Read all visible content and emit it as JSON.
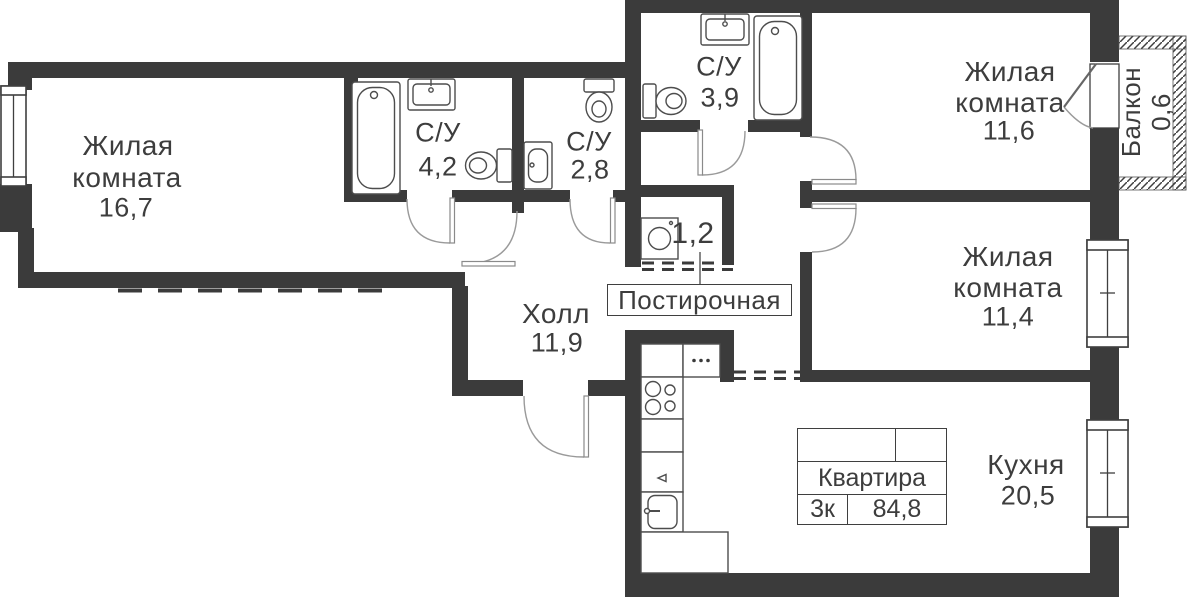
{
  "colors": {
    "wall": "#3b3b3b",
    "line": "#4d4d4d",
    "arc": "#9a9a9a",
    "text": "#3d3d3d"
  },
  "rooms": {
    "living1": {
      "line1": "Жилая",
      "line2": "комната",
      "area": "16,7"
    },
    "bath1": {
      "name": "С/У",
      "area": "4,2"
    },
    "bath2": {
      "name": "С/У",
      "area": "2,8"
    },
    "bath3": {
      "name": "С/У",
      "area": "3,9"
    },
    "living2": {
      "line1": "Жилая",
      "line2": "комната",
      "area": "11,6"
    },
    "living3": {
      "line1": "Жилая",
      "line2": "комната",
      "area": "11,4"
    },
    "balcony": {
      "name": "Балкон",
      "area": "0,6"
    },
    "laundry": {
      "area": "1,2",
      "callout": "Постирочная"
    },
    "hall": {
      "name": "Холл",
      "area": "11,9"
    },
    "kitchen": {
      "name": "Кухня",
      "area": "20,5"
    }
  },
  "summary": {
    "title": "Квартира",
    "rooms": "3к",
    "area": "84,8"
  }
}
